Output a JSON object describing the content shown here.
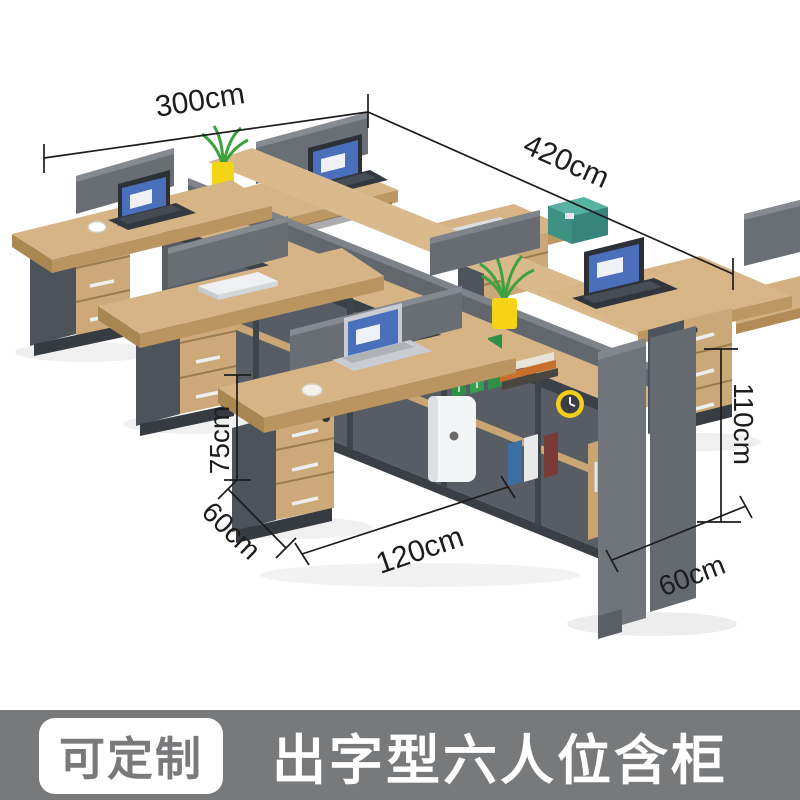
{
  "product": {
    "badge": "可定制",
    "title": "出字型六人位含柜"
  },
  "dimensions": {
    "back_width": "300cm",
    "total_length": "420cm",
    "desk_height": "75cm",
    "left_depth": "60cm",
    "desk_width": "120cm",
    "cabinet_height": "110cm",
    "right_depth": "60cm"
  },
  "palette": {
    "wood": "#d6b486",
    "wood_edge": "#bd9761",
    "panel_gray": "#6a6f76",
    "cabinet_gray": "#4d545c",
    "divider_gray": "#62676e",
    "annotation_line": "#1c1c1c",
    "footer_bar": "#77797b",
    "footer_text": "#ffffff",
    "badge_background": "#ffffff",
    "pot_yellow": "#f4d414",
    "plant_green": "#3da23d",
    "box_teal": "#3f9184",
    "screen_blue": "#4a70bc"
  }
}
